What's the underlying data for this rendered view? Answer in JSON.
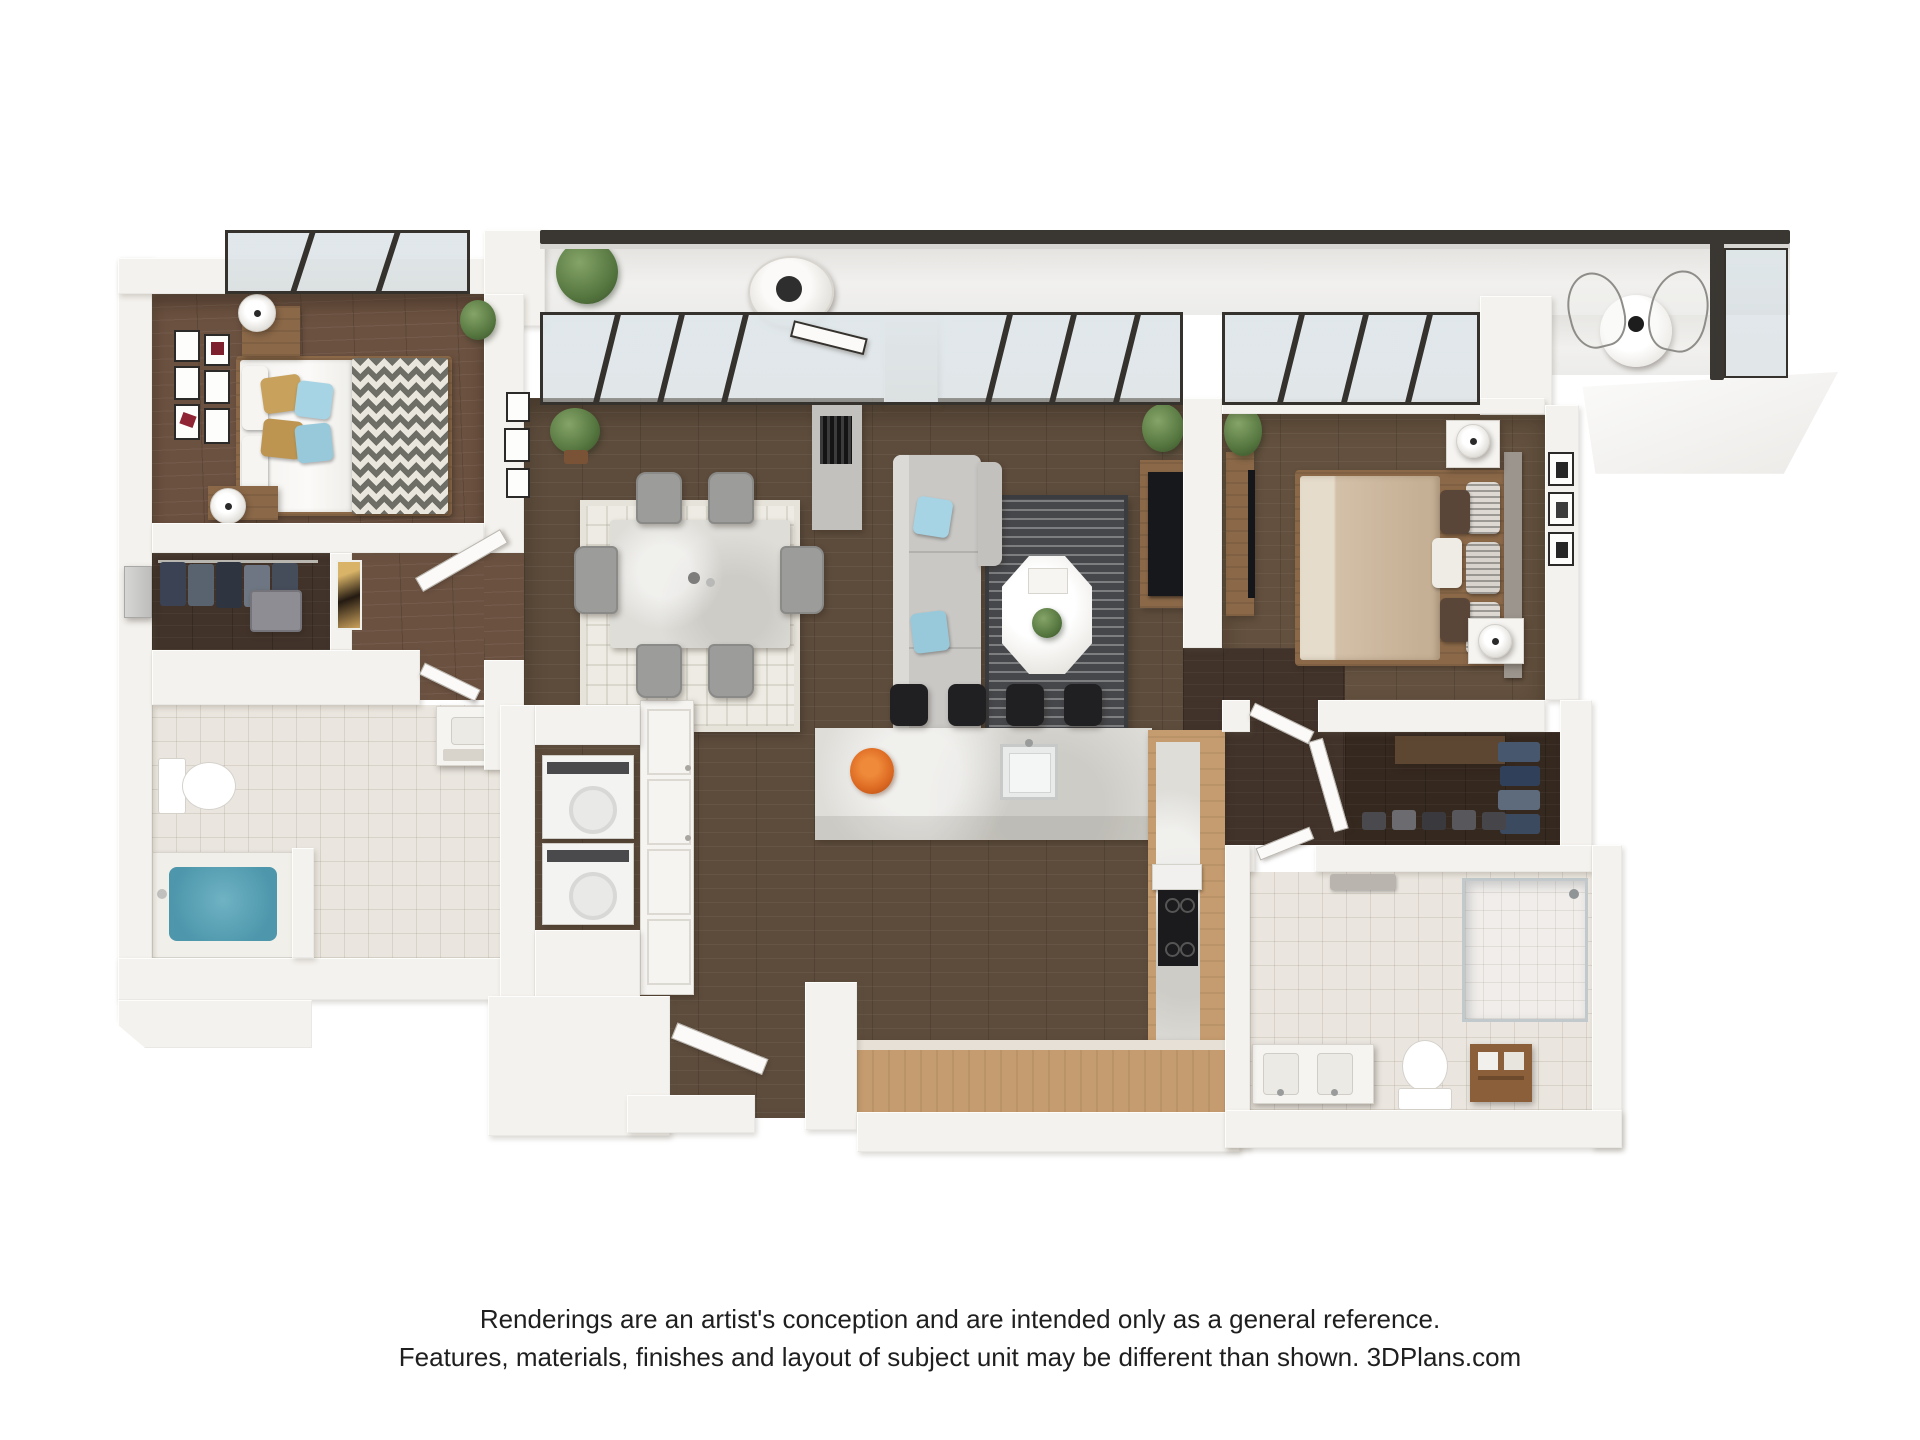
{
  "disclaimer": {
    "line1": "Renderings are an artist's conception and are intended only as a general reference.",
    "line2": "Features, materials, finishes and layout of subject unit may be different than shown. 3DPlans.com"
  },
  "brand": "3DPlans.com",
  "floorplan": {
    "type": "3d-rendered-apartment-floor-plan",
    "view": "top-down dollhouse",
    "rooms": [
      {
        "name": "balcony",
        "furniture": [
          "hanging-egg-chair",
          "fiddle-leaf-plant",
          "round-cafe-table",
          "wire-chairs",
          "glass-railing"
        ]
      },
      {
        "name": "bedroom-2",
        "furniture": [
          "queen-bed-chevron-throw",
          "gold-pillows",
          "blue-pillows",
          "two-wood-nightstands",
          "two-lamps",
          "gallery-wall-frames",
          "corner-windows"
        ]
      },
      {
        "name": "closet-1",
        "furniture": [
          "hanging-clothes",
          "suitcase",
          "wall-panel"
        ]
      },
      {
        "name": "hallway",
        "furniture": [
          "abstract-art",
          "open-door"
        ]
      },
      {
        "name": "bathroom-1",
        "furniture": [
          "toilet",
          "soaking-tub-blue",
          "vanity-sink",
          "marble-tile-floor"
        ]
      },
      {
        "name": "laundry-closet",
        "furniture": [
          "stacked-washer-dryer"
        ]
      },
      {
        "name": "pantry",
        "furniture": [
          "white-cabinet"
        ]
      },
      {
        "name": "dining-area",
        "furniture": [
          "marble-dining-table",
          "six-gray-chairs",
          "patterned-area-rug",
          "wall-frames",
          "potted-plants"
        ]
      },
      {
        "name": "living-area",
        "furniture": [
          "gray-sofa",
          "blue-accent-pillows",
          "dark-striped-rug",
          "octagonal-coffee-table",
          "floor-lamp",
          "tv-console",
          "fireplace-column",
          "window-wall",
          "balcony-door"
        ]
      },
      {
        "name": "kitchen",
        "furniture": [
          "marble-island",
          "four-black-bar-stools",
          "sink",
          "orange-flower-vase",
          "wood-cabinet-runs",
          "cooktop",
          "range-hood"
        ]
      },
      {
        "name": "entry",
        "furniture": [
          "open-front-door"
        ]
      },
      {
        "name": "master-bedroom",
        "furniture": [
          "king-bed-tan-duvet",
          "gray-headboard",
          "two-white-nightstands",
          "two-lamps",
          "tv-console",
          "art-frames",
          "plant",
          "corner-windows"
        ]
      },
      {
        "name": "walk-in-closet",
        "furniture": [
          "hanging-clothes",
          "shelf",
          "shoe-rows",
          "door"
        ]
      },
      {
        "name": "master-bathroom",
        "furniture": [
          "double-vanity",
          "toilet",
          "glass-shower",
          "wood-shelf",
          "towel-bar",
          "marble-tile-floor"
        ]
      }
    ],
    "counts": {
      "bar_stools": 4,
      "dining_chairs": 6,
      "bedrooms": 2,
      "bathrooms": 2
    }
  },
  "colors": {
    "bg": "#ffffff",
    "wall": "#f4f2ee",
    "railing": "#3a3733",
    "cabinet": "#c59c6f",
    "rug-dark": "#45474b",
    "rug-light": "#edebe3",
    "stool": "#202022",
    "sofa": "#c9c8c5",
    "pillow-blue": "#a6d4e4",
    "pillow-gold": "#c8a25c",
    "tub-blue": "#4d96ab",
    "duvet-tan": "#d3c0a8",
    "flowers-orange": "#dd6a22"
  }
}
